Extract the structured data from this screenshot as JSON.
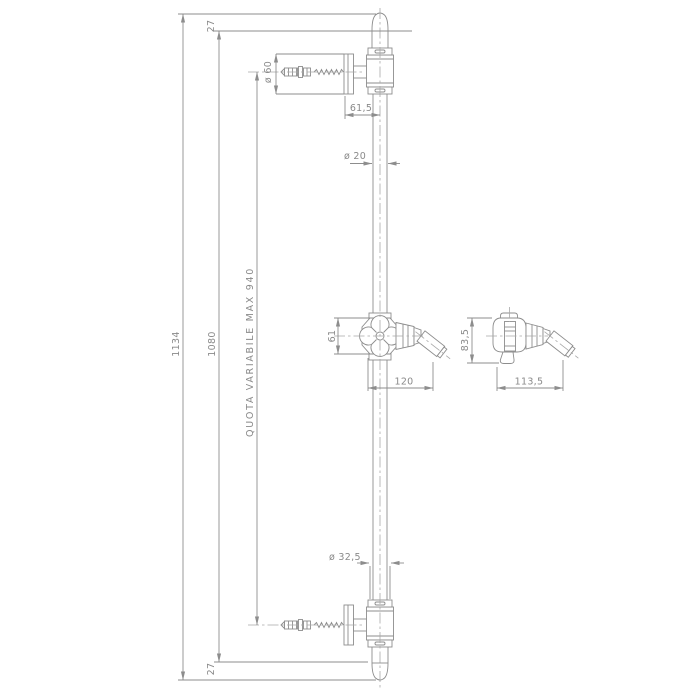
{
  "drawing": {
    "type": "technical-dimension-drawing",
    "subject": "shower sliding rail with wall brackets and hand-shower holder",
    "units": "mm",
    "labels": {
      "offset_top": "27",
      "flange_diameter": "ø 60",
      "wall_to_rail_center": "61,5",
      "rail_diameter": "ø 20",
      "total_height": "1134",
      "inner_height": "1080",
      "fixing_span": "QUOTA VARIABILE MAX 940",
      "slider_height": "61",
      "slider_reach": "120",
      "holder_height": "83,5",
      "holder_reach": "113,5",
      "bracket_diameter": "ø 32,5",
      "offset_bottom": "27"
    },
    "colors": {
      "line": "#8d8d8d",
      "centerline": "#a8a8a8",
      "text": "#8a8a8a",
      "background": "#ffffff"
    }
  }
}
